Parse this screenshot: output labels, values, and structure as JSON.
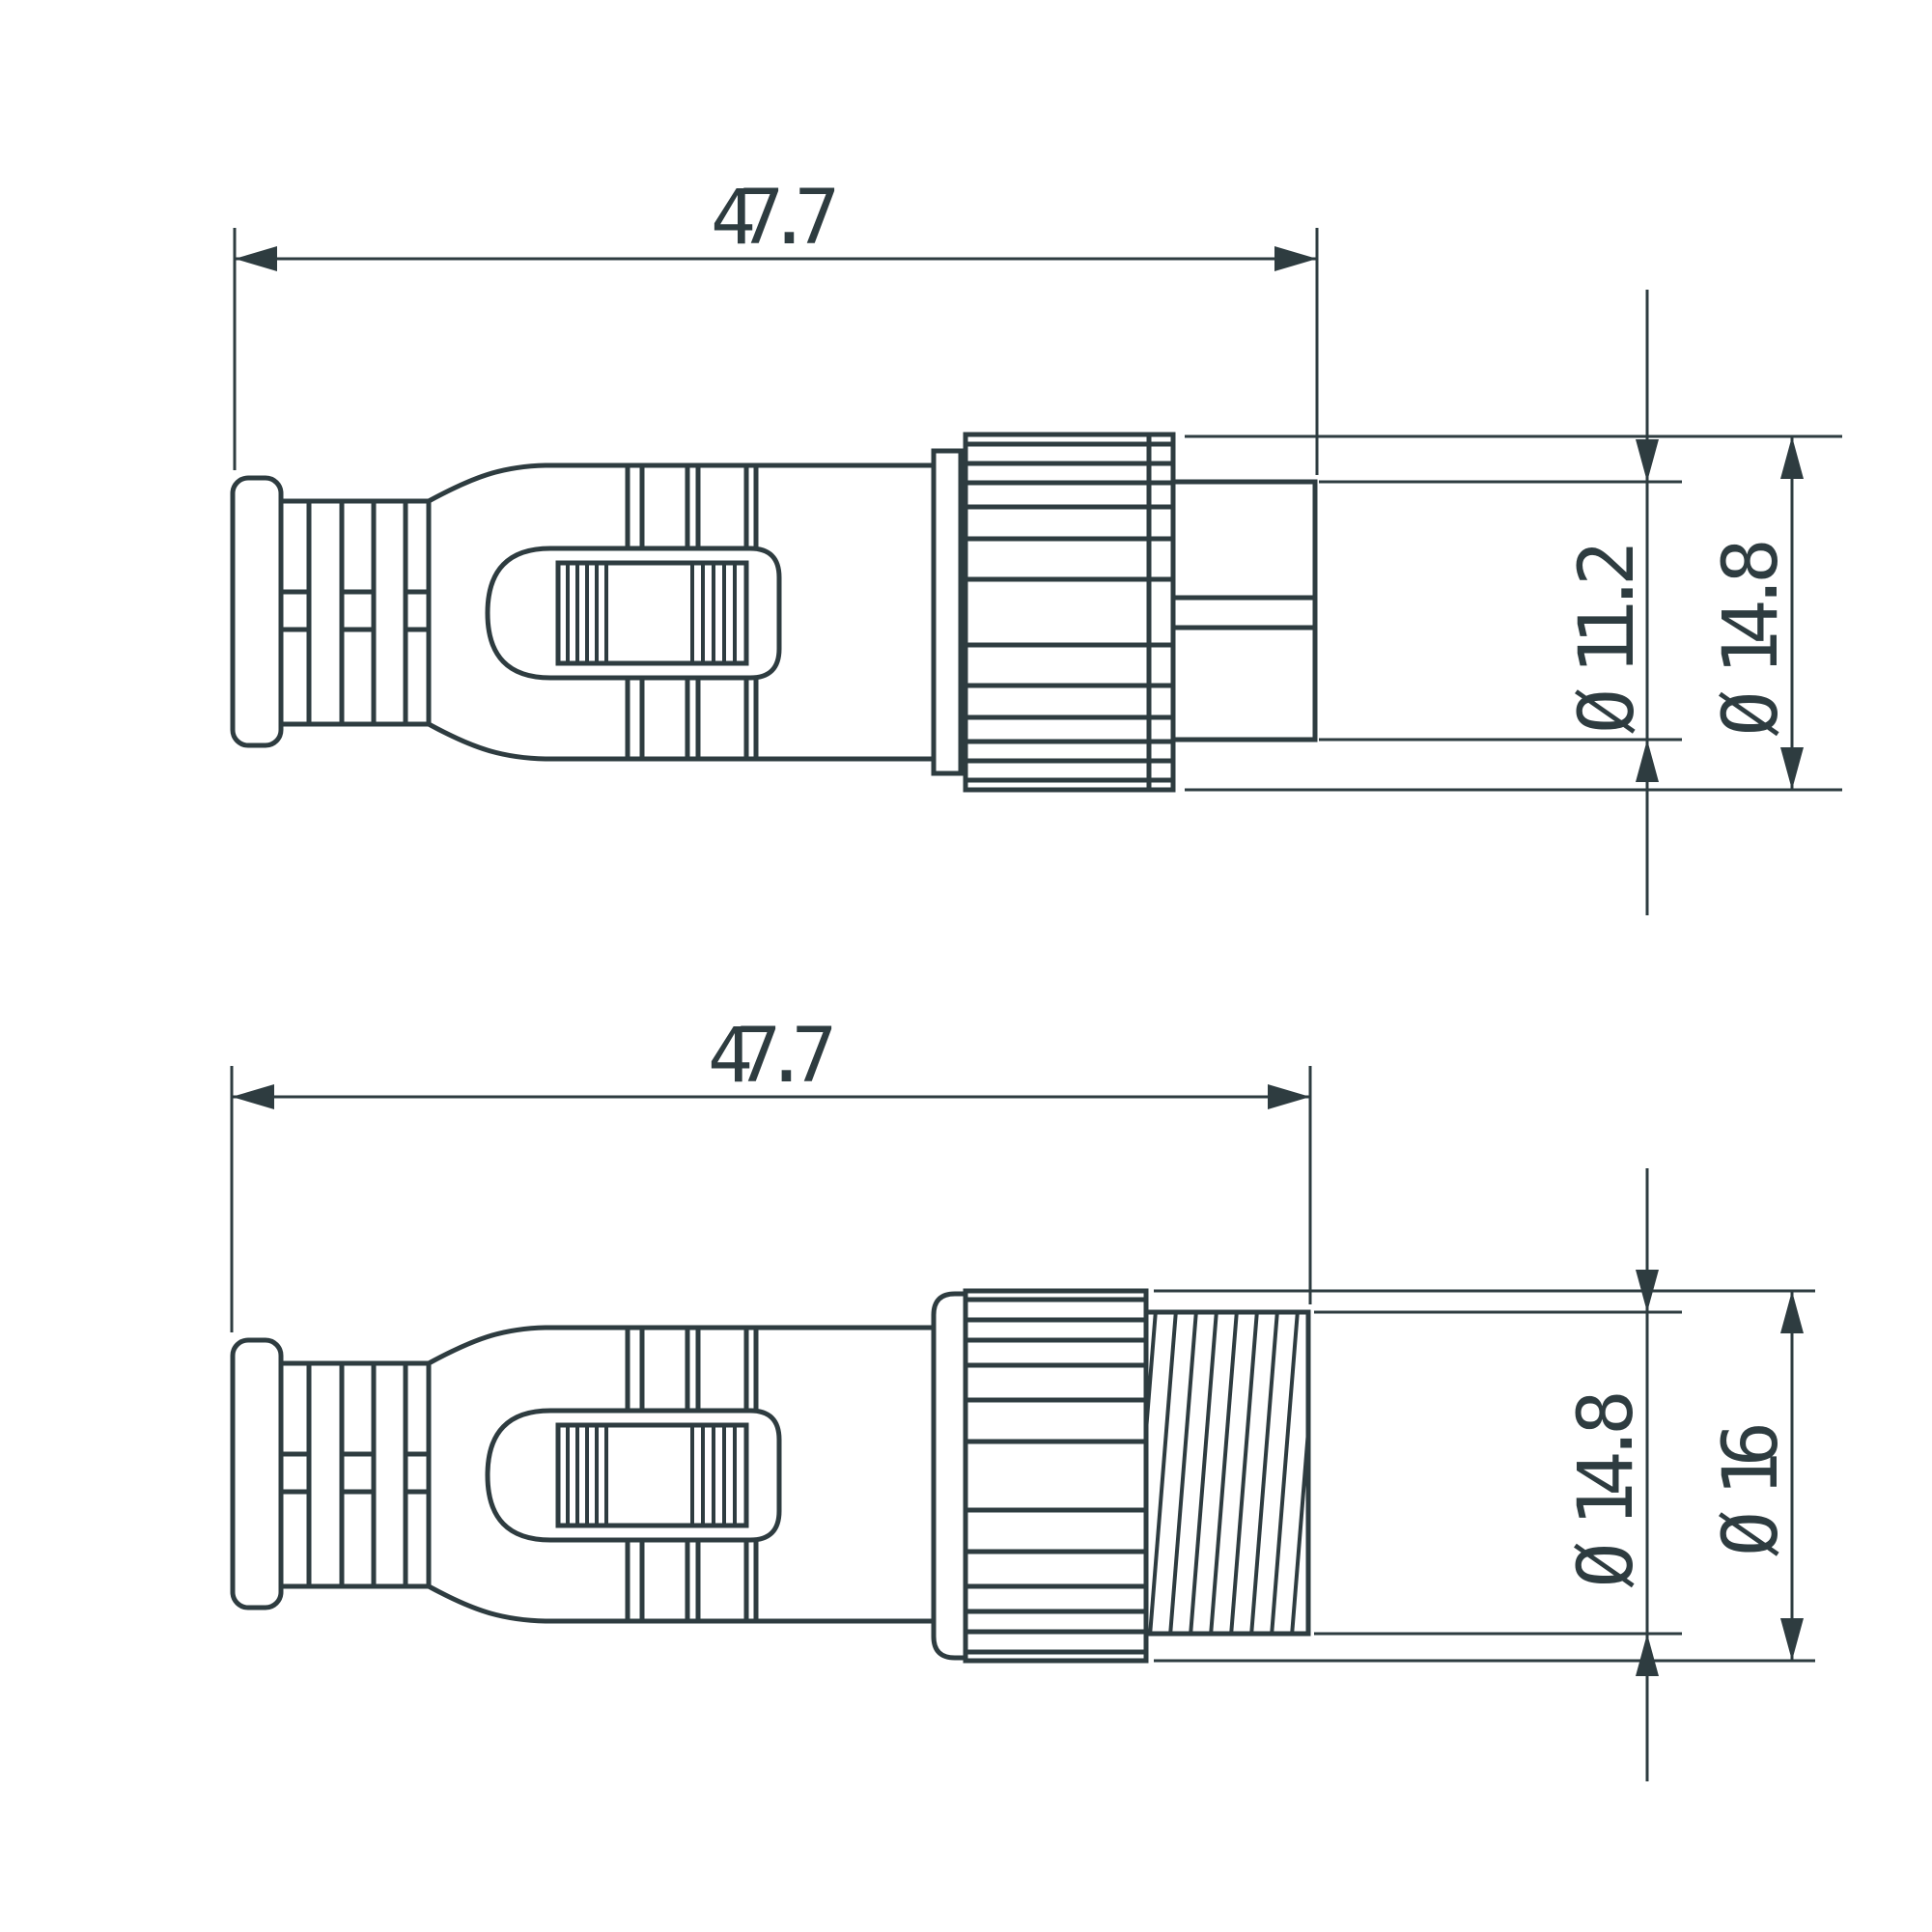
{
  "drawing": {
    "background_color": "#ffffff",
    "line_color": "#2e3c40",
    "views": [
      {
        "name": "connector side view with male insert",
        "dimensions": {
          "length": "47.7",
          "insert_diameter": "Ø 11.2",
          "nut_diameter": "Ø 14.8"
        }
      },
      {
        "name": "connector side view with threaded coupling",
        "dimensions": {
          "length": "47.7",
          "thread_diameter": "Ø 14.8",
          "nut_diameter": "Ø 16"
        }
      }
    ]
  }
}
